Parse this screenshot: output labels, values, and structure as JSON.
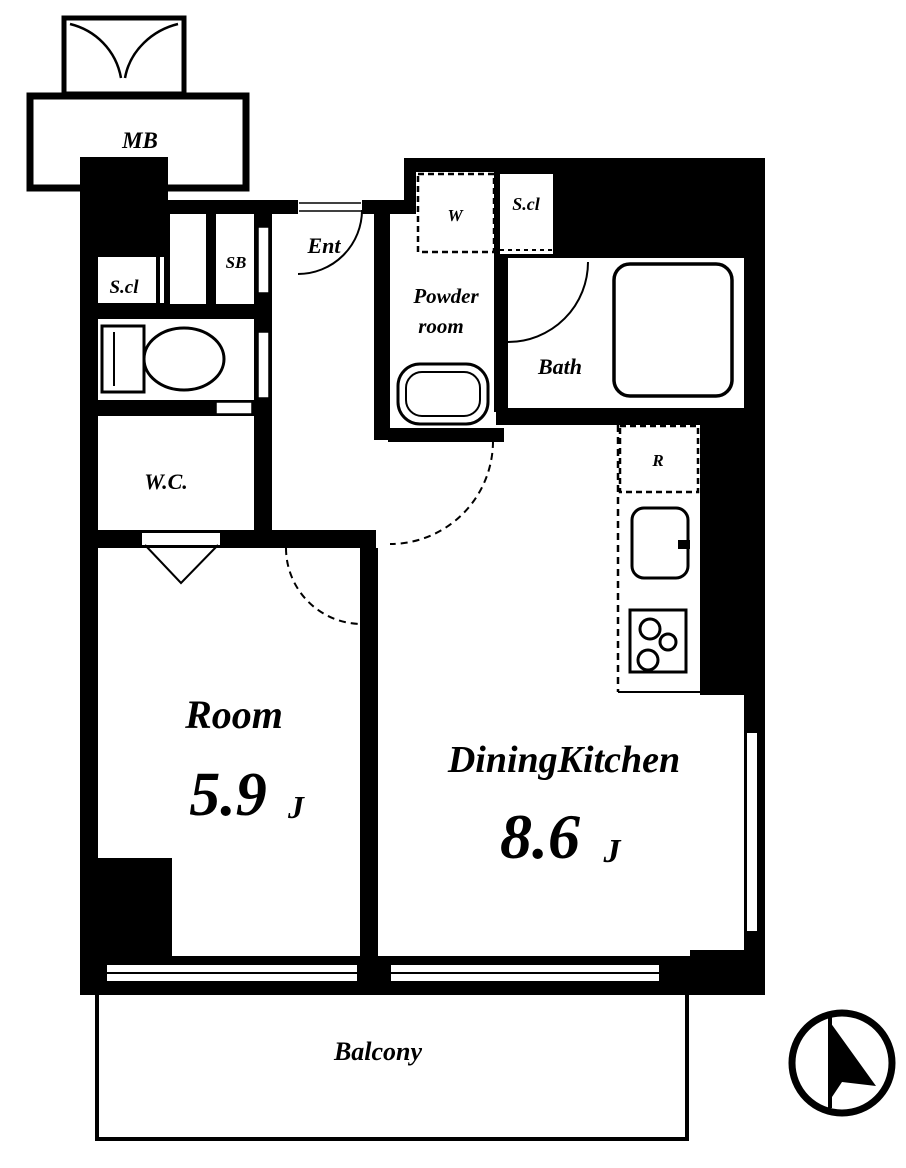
{
  "type": "floor_plan",
  "title": "1DK apartment floor plan",
  "colors": {
    "ink": "#000000",
    "background": "#ffffff"
  },
  "rooms": {
    "meter_box": {
      "label": "MB"
    },
    "closet_left": {
      "label": "S.cl"
    },
    "shoe_box": {
      "label": "SB"
    },
    "entrance": {
      "label": "Ent"
    },
    "toilet": {
      "label": "W.C."
    },
    "closet_top": {
      "label": "S.cl"
    },
    "powder_room": {
      "label_line1": "Powder",
      "label_line2": "room"
    },
    "bath": {
      "label": "Bath"
    },
    "room": {
      "label": "Room",
      "size_value": "5.9",
      "size_unit": "J"
    },
    "dining_kitchen": {
      "label": "DiningKitchen",
      "size_value": "8.6",
      "size_unit": "J"
    },
    "balcony": {
      "label": "Balcony"
    }
  },
  "appliances": {
    "washer_space": {
      "label": "W"
    },
    "refrigerator": {
      "label": "R"
    }
  },
  "fixtures": [
    "toilet",
    "washbasin",
    "bathtub",
    "kitchen-sink",
    "stove-3-burner"
  ],
  "compass": {
    "needle_direction": "north-up"
  }
}
